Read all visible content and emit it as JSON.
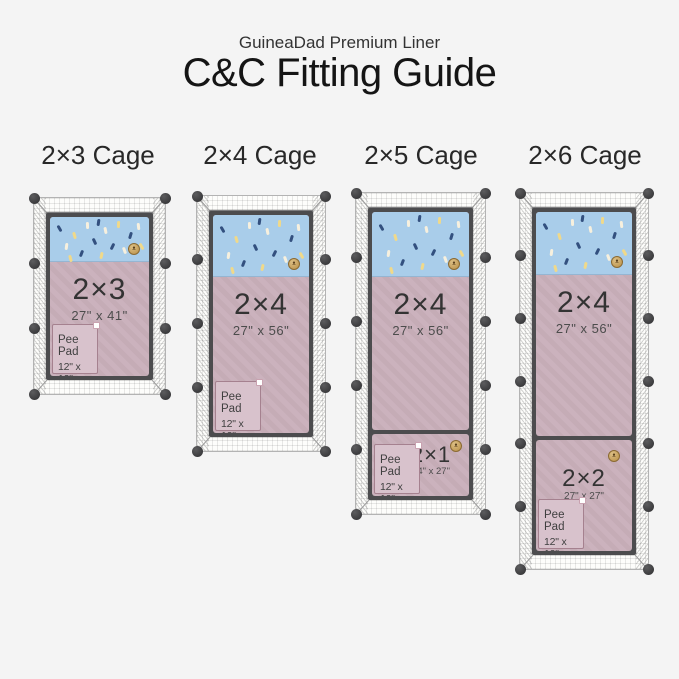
{
  "header": {
    "subtitle": "GuineaDad Premium Liner",
    "title": "C&C Fitting Guide"
  },
  "colors": {
    "background": "#f4f4f4",
    "liner_fleece_top": "#a9cdea",
    "liner_body": "#c9afba",
    "pee_pad": "#d8c2cc",
    "cage_frame": "#4c4c4e",
    "connector_dot": "#2e2e30",
    "badge_gold": "#b98f46",
    "confetti_navy": "#33507f",
    "confetti_cream": "#f7f0de",
    "confetti_yellow": "#f0d98a"
  },
  "cages": [
    {
      "title": "2×3 Cage",
      "liners": [
        {
          "name": "2×3",
          "dims": "27\" x 41\""
        }
      ],
      "pee_pad": {
        "label": "Pee Pad",
        "dims": "12\" x 12\""
      }
    },
    {
      "title": "2×4 Cage",
      "liners": [
        {
          "name": "2×4",
          "dims": "27\" x 56\""
        }
      ],
      "pee_pad": {
        "label": "Pee Pad",
        "dims": "12\" x 12\""
      }
    },
    {
      "title": "2×5 Cage",
      "liners": [
        {
          "name": "2×4",
          "dims": "27\" x 56\""
        },
        {
          "name": "2×1",
          "dims": "14\" x 27\""
        }
      ],
      "pee_pad": {
        "label": "Pee Pad",
        "dims": "12\" x 12\""
      }
    },
    {
      "title": "2×6 Cage",
      "liners": [
        {
          "name": "2×4",
          "dims": "27\" x 56\""
        },
        {
          "name": "2×2",
          "dims": "27\" x 27\""
        }
      ],
      "pee_pad": {
        "label": "Pee Pad",
        "dims": "12\" x 12\""
      }
    }
  ]
}
